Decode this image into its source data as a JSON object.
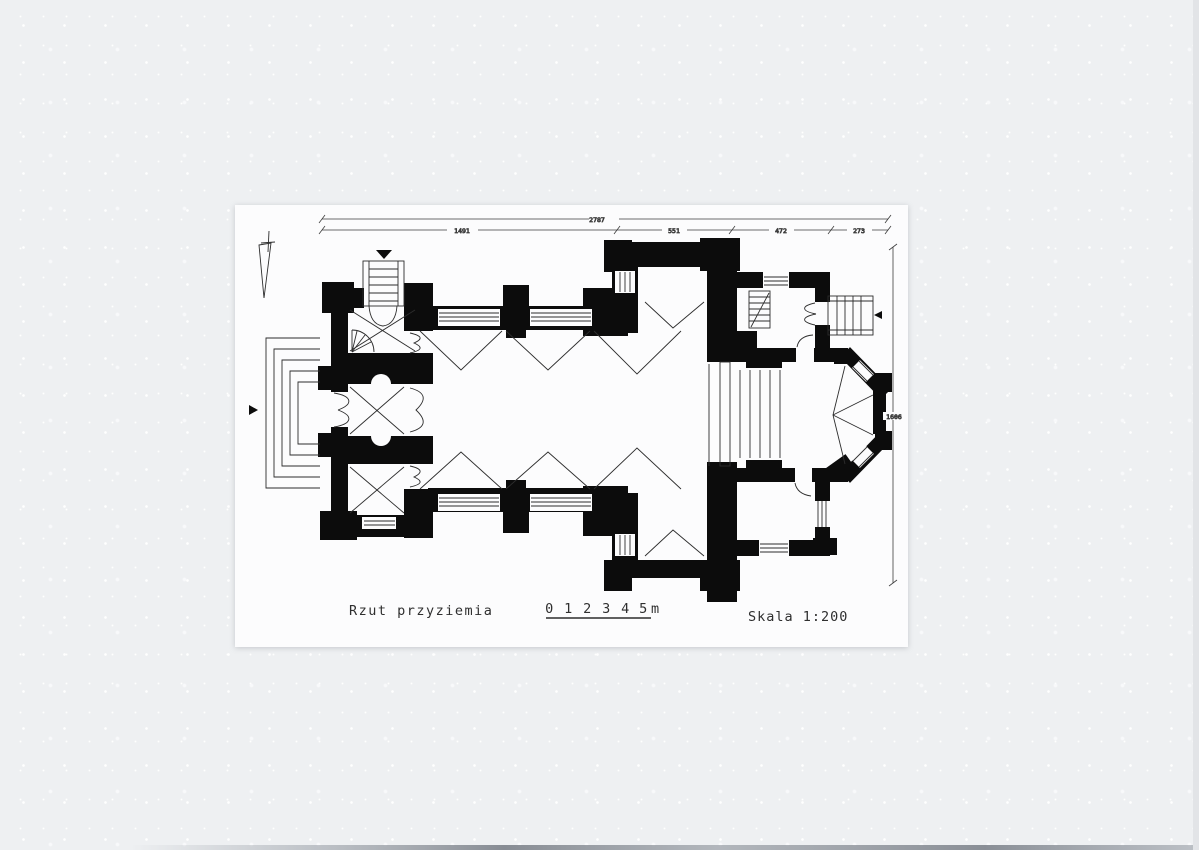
{
  "sheet": {
    "drawing_title": "Rzut przyziemia",
    "scale_label": "Skala 1:200",
    "scale_bar": {
      "marks": [
        "0",
        "1",
        "2",
        "3",
        "4",
        "5"
      ],
      "unit_suffix": "m"
    },
    "dimensions": {
      "total_width": "2787",
      "segments": [
        "1491",
        "551",
        "472",
        "273"
      ],
      "side_height": "1606"
    },
    "colors": {
      "ink": "#0c0c0c",
      "paper": "#fcfcfd",
      "scan_background": "#eef0f2"
    }
  }
}
